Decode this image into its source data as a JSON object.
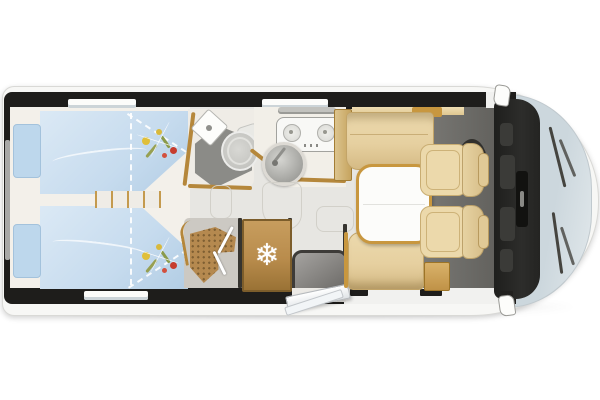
{
  "meta": {
    "title": "Motorhome floor plan - top-down view",
    "type": "floorplan-diagram"
  },
  "icons": {
    "fridge_snowflake": "❄"
  },
  "colors": {
    "page_bg": "#ffffff",
    "body_white": "#f7f7f5",
    "wall_black": "#1e1d1b",
    "floor_gray": "#e7e6e2",
    "bedroom_floor": "#f3f0ea",
    "bed_blue": "#c6dbee",
    "bed_blue_light": "#dbe9f5",
    "pillow_blue": "#bdd7ec",
    "wood_gold": "#b5873b",
    "bench_beige": "#e6d0a0",
    "chair_beige": "#ecd9ab",
    "cab_floor": "#6f6e6a",
    "dashboard_black": "#232321",
    "windshield_blue": "#ccd7dd",
    "fridge_tan": "#b98c4c",
    "shower_wood": "#b5894f",
    "bath_floor": "#8b8b87",
    "counter_cream": "#f2efe8"
  },
  "rooms": {
    "bedroom": "rear twin beds with steps",
    "bathroom": "washroom with corner sink and toilet",
    "kitchen": "two-burner hob with round sink",
    "shower": "separate shower cubicle with wooden grate",
    "fridge": "refrigerator",
    "entry": "habitation door with entry mat",
    "dinette": "face-to-face lounge with table",
    "cab": "driver cab with two swivel seats"
  }
}
